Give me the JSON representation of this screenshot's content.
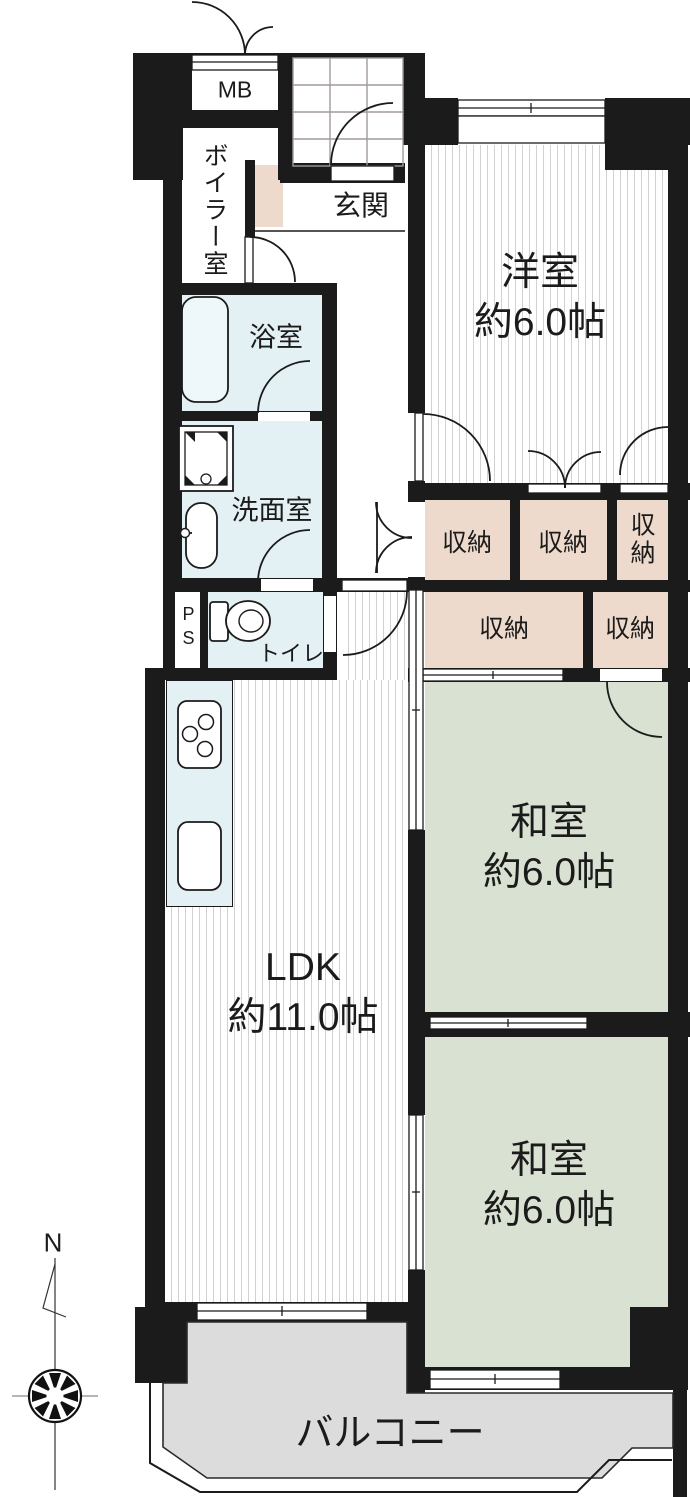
{
  "rooms": {
    "western": {
      "name": "洋室",
      "size": "約6.0帖"
    },
    "japanese1": {
      "name": "和室",
      "size": "約6.0帖"
    },
    "japanese2": {
      "name": "和室",
      "size": "約6.0帖"
    },
    "ldk": {
      "name": "LDK",
      "size": "約11.0帖"
    },
    "balcony": {
      "name": "バルコニー"
    },
    "entrance": {
      "name": "玄関"
    },
    "bathroom": {
      "name": "浴室"
    },
    "washroom": {
      "name": "洗面室"
    },
    "toilet": {
      "name": "トイレ"
    },
    "boiler": {
      "name": "ボイラー室"
    },
    "meter_box": {
      "name": "MB"
    },
    "pipe_shaft": {
      "name": "PS"
    }
  },
  "closets": [
    {
      "label": "収納"
    },
    {
      "label": "収納"
    },
    {
      "label": "収納"
    },
    {
      "label": "収納"
    },
    {
      "label": "収納"
    }
  ],
  "compass": {
    "north": "N"
  },
  "colors": {
    "wall": "#1b1b1b",
    "tatami_green": "#d8e1d2",
    "closet_pink": "#eedacd",
    "wet_area_blue": "#e4f1f4",
    "balcony_gray": "#dcdcdc",
    "flooring_stripe": "#d2d2d2",
    "porch_grid": "#a39a9a"
  }
}
